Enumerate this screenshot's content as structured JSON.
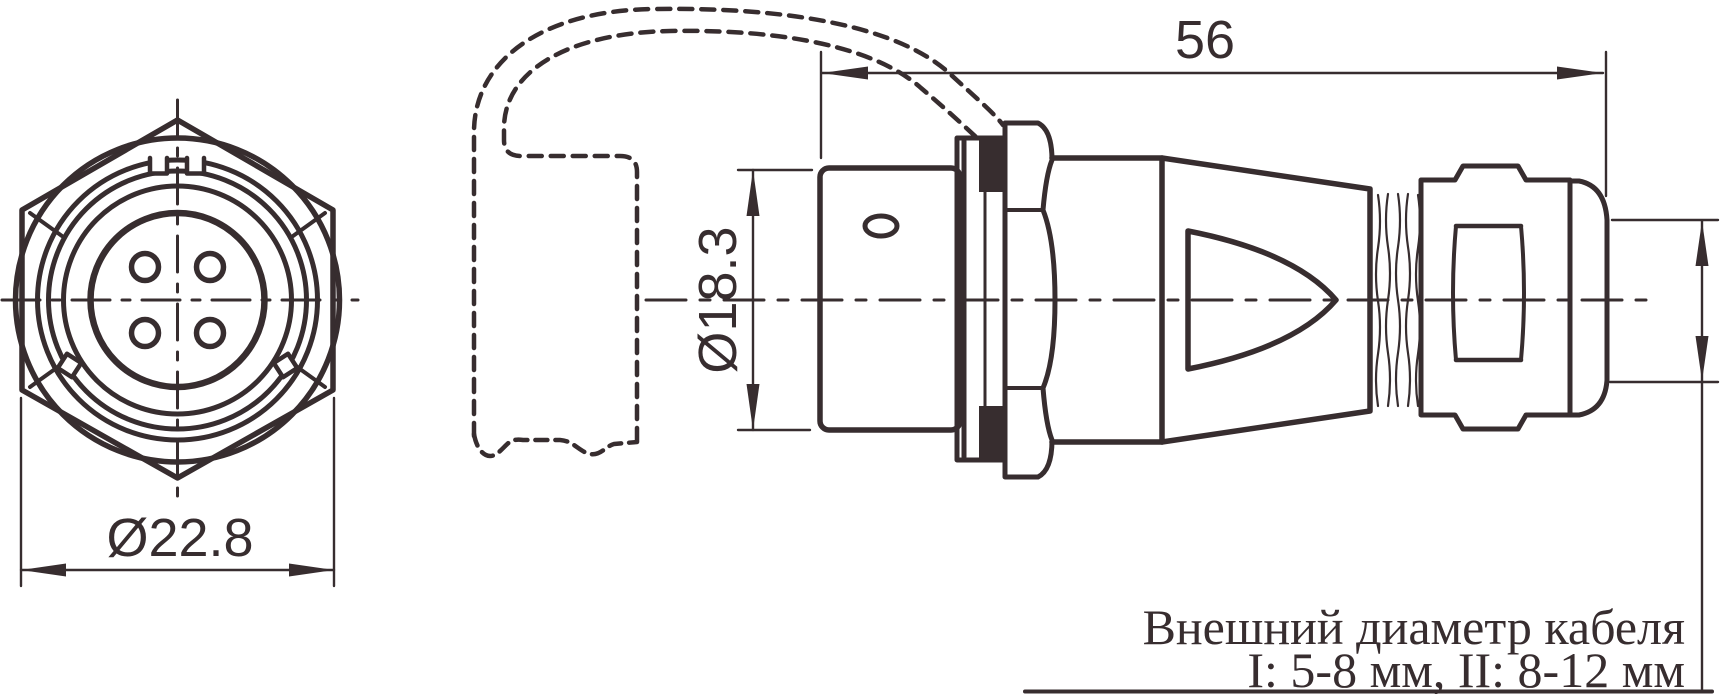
{
  "drawing": {
    "type": "connector technical drawing",
    "colors": {
      "ink": "#372d2f",
      "background": "#ffffff"
    },
    "front_view": {
      "name": "connector front view",
      "pin_count": 4,
      "diameter_dimension": "Ø22.8"
    },
    "side_view": {
      "name": "connector side view with phantom mating cable",
      "length_dimension": "56",
      "barrel_diameter_dimension": "Ø18.3"
    },
    "note": {
      "line1": "Внешний диаметр кабеля",
      "line2": "I: 5-8 мм, II: 8-12 мм"
    }
  }
}
